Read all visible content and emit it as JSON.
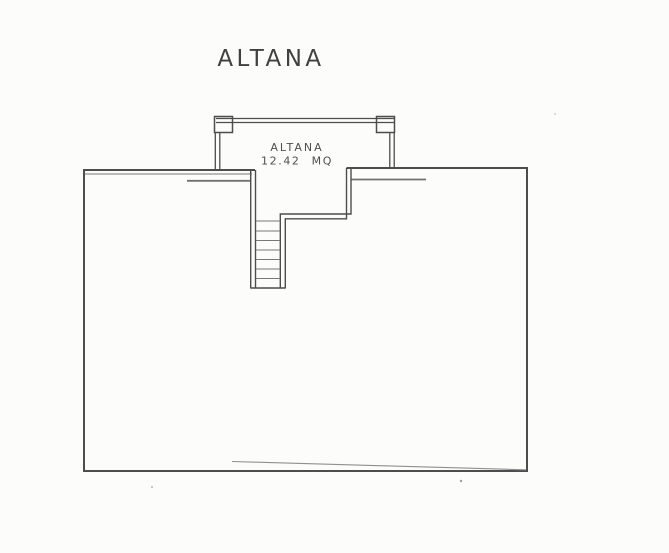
{
  "theme": {
    "paper_bg": "#fcfcfb",
    "wall_color": "#4d4d4d",
    "thin_line": "#787878",
    "title_color": "#414141",
    "label_color": "#4f4f4f"
  },
  "drawing": {
    "title": "ALTANA",
    "room": {
      "name": "ALTANA",
      "area": "12.42 MQ"
    },
    "stairs": {
      "visible_step_lines": 7
    }
  }
}
